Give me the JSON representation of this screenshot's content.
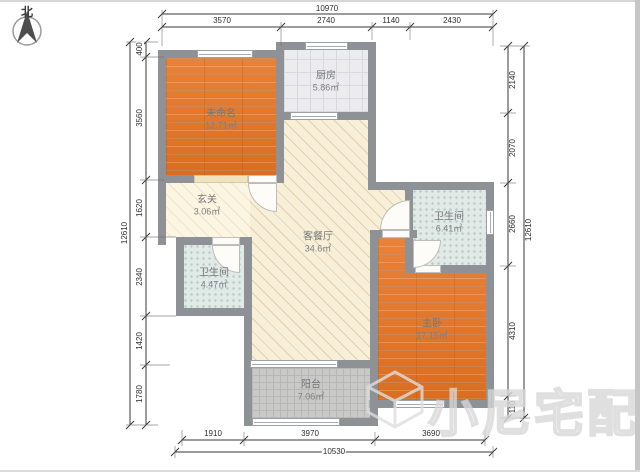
{
  "compass": {
    "label": "北"
  },
  "rooms": [
    {
      "name": "未命名",
      "area": "12.71㎡"
    },
    {
      "name": "厨房",
      "area": "5.86㎡"
    },
    {
      "name": "玄关",
      "area": "3.06㎡"
    },
    {
      "name": "客餐厅",
      "area": "34.6㎡"
    },
    {
      "name": "卫生间",
      "area": "6.41㎡"
    },
    {
      "name": "卫生间",
      "area": "4.47㎡"
    },
    {
      "name": "主卧",
      "area": "17.15㎡"
    },
    {
      "name": "阳台",
      "area": "7.06㎡"
    }
  ],
  "dimensions": {
    "top": {
      "overall": "10970",
      "segments": [
        "3570",
        "2740",
        "1140",
        "2430"
      ]
    },
    "left": {
      "overall": "12610",
      "segments": [
        "400",
        "3560",
        "1620",
        "2340",
        "1420",
        "1780"
      ]
    },
    "right": {
      "overall": "12610",
      "segments": [
        "2140",
        "2070",
        "2660",
        "4310",
        "110"
      ]
    },
    "bottom": {
      "overall": "10530",
      "segments": [
        "1910",
        "3970",
        "3690"
      ]
    }
  },
  "watermark": {
    "text": "小尼宅配"
  },
  "colors": {
    "wall": "#8e9196",
    "wood_floor": "#e0762c",
    "living_floor": "#f7efd8",
    "tile_floor": "#ececee",
    "bath_floor": "#e2eae7",
    "balcony_floor": "#c9c9c8"
  }
}
